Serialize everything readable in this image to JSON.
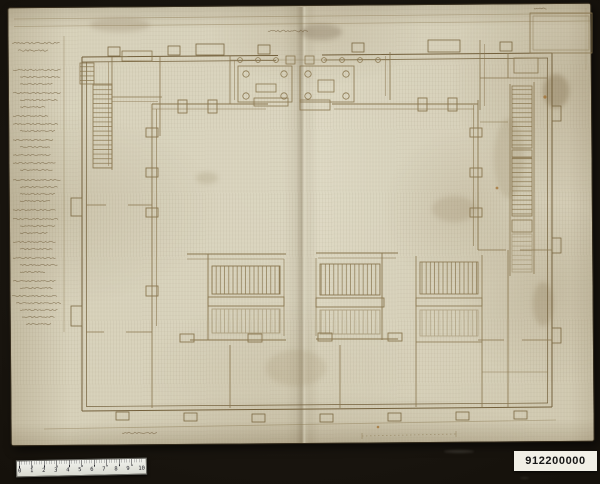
{
  "scan": {
    "background_color": "#1a1610",
    "paper_color": "#d8d2bb",
    "ink_color": "#8a7750"
  },
  "inventory_label": {
    "text": "912200000"
  },
  "ruler": {
    "numbers": [
      "0",
      "1",
      "2",
      "3",
      "4",
      "5",
      "6",
      "7",
      "8",
      "9",
      "10"
    ]
  },
  "legend": {
    "legible": false,
    "lines": [
      {
        "y": 43,
        "x0": 12,
        "x1": 61,
        "a": 1.3
      },
      {
        "y": 50.5,
        "x0": 18,
        "x1": 50,
        "a": 1.2
      },
      {
        "y": 70,
        "x0": 13,
        "x1": 62
      },
      {
        "y": 77,
        "x0": 20,
        "x1": 61
      },
      {
        "y": 84,
        "x0": 20,
        "x1": 53
      },
      {
        "y": 93,
        "x0": 13,
        "x1": 61
      },
      {
        "y": 100,
        "x0": 20,
        "x1": 59
      },
      {
        "y": 107,
        "x0": 20,
        "x1": 46
      },
      {
        "y": 116,
        "x0": 13,
        "x1": 49
      },
      {
        "y": 124,
        "x0": 13,
        "x1": 59
      },
      {
        "y": 131,
        "x0": 20,
        "x1": 56
      },
      {
        "y": 140,
        "x0": 13,
        "x1": 53
      },
      {
        "y": 147,
        "x0": 20,
        "x1": 51
      },
      {
        "y": 155,
        "x0": 13,
        "x1": 51
      },
      {
        "y": 163,
        "x0": 13,
        "x1": 56
      },
      {
        "y": 170,
        "x0": 20,
        "x1": 53
      },
      {
        "y": 180,
        "x0": 13,
        "x1": 62
      },
      {
        "y": 187,
        "x0": 20,
        "x1": 59
      },
      {
        "y": 194,
        "x0": 20,
        "x1": 57
      },
      {
        "y": 201,
        "x0": 20,
        "x1": 51
      },
      {
        "y": 210,
        "x0": 13,
        "x1": 56
      },
      {
        "y": 219,
        "x0": 13,
        "x1": 59
      },
      {
        "y": 226,
        "x0": 20,
        "x1": 57
      },
      {
        "y": 233,
        "x0": 20,
        "x1": 49
      },
      {
        "y": 242,
        "x0": 13,
        "x1": 57
      },
      {
        "y": 249,
        "x0": 20,
        "x1": 53
      },
      {
        "y": 258,
        "x0": 13,
        "x1": 56
      },
      {
        "y": 265,
        "x0": 20,
        "x1": 59
      },
      {
        "y": 272,
        "x0": 20,
        "x1": 46
      },
      {
        "y": 281,
        "x0": 13,
        "x1": 57
      },
      {
        "y": 288,
        "x0": 20,
        "x1": 53
      },
      {
        "y": 296,
        "x0": 12,
        "x1": 59
      },
      {
        "y": 303,
        "x0": 16,
        "x1": 61
      },
      {
        "y": 310,
        "x0": 20,
        "x1": 59
      },
      {
        "y": 317,
        "x0": 22,
        "x1": 56
      },
      {
        "y": 324,
        "x0": 26,
        "x1": 51
      },
      {
        "y": 31,
        "x0": 268,
        "x1": 310,
        "a": 1.4
      },
      {
        "y": 433,
        "x0": 122,
        "x1": 158,
        "a": 1.2
      },
      {
        "y": 8.5,
        "x0": 534,
        "x1": 547
      }
    ]
  }
}
